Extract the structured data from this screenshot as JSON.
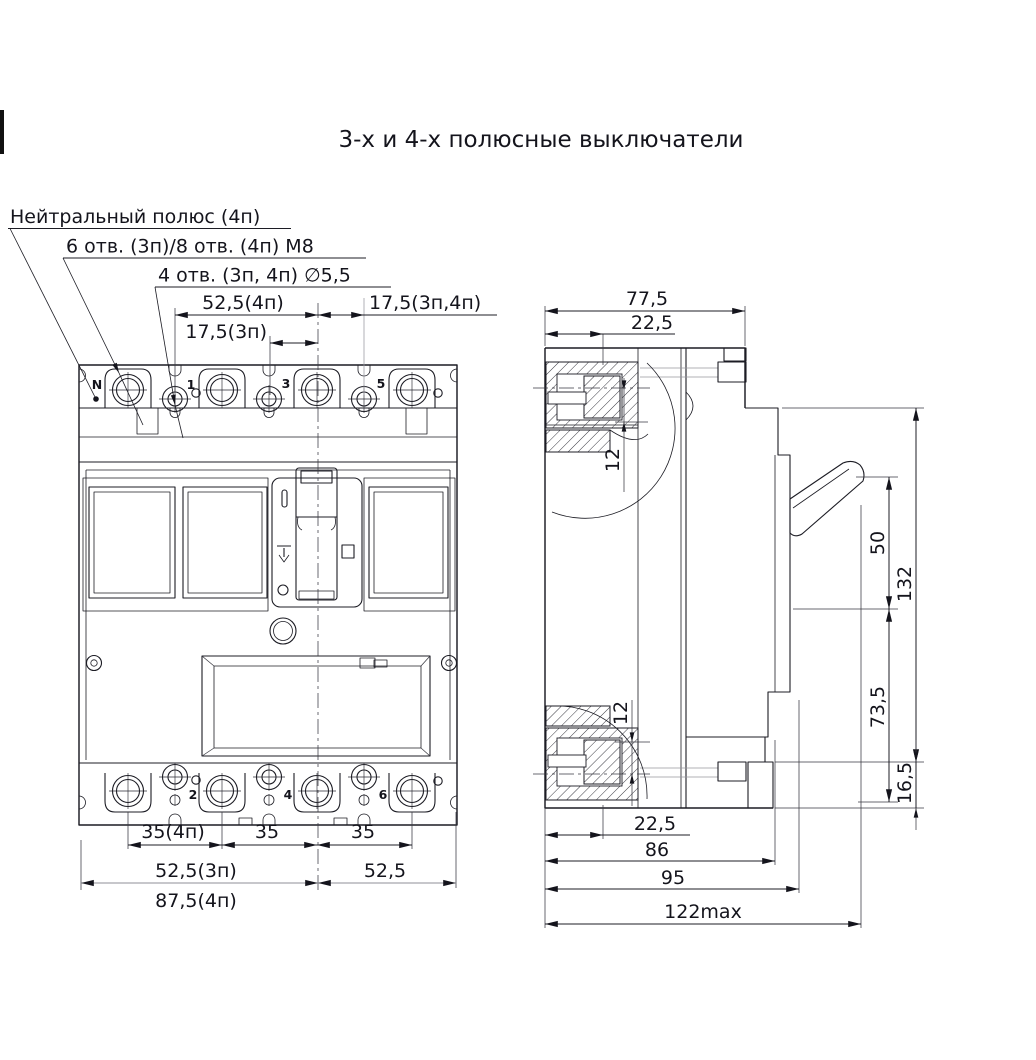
{
  "title": "3-х и 4-х полюсные выключатели",
  "callouts": {
    "neutral_pole": "Нейтральный полюс (4п)",
    "mounting_holes_m8": "6 отв. (3п)/8 отв. (4п) М8",
    "holes_d55": "4 отв. (3п, 4п) ∅5,5"
  },
  "front_view": {
    "terminals_top": [
      "N",
      "1",
      "3",
      "5"
    ],
    "terminals_bottom": [
      "2",
      "4",
      "6"
    ],
    "dims_top": {
      "half_span_4p": "52,5(4п)",
      "offset_3p": "17,5(3п)",
      "offset_right": "17,5(3п,4п)"
    },
    "dims_bottom": {
      "pitch_neutral": "35(4п)",
      "pitch_mid": "35",
      "pitch_right": "35",
      "half_left_3p": "52,5(3п)",
      "half_left_4p": "87,5(4п)",
      "half_right": "52,5"
    }
  },
  "side_view": {
    "dims_top": {
      "depth_total": "77,5",
      "terminal_depth": "22,5",
      "terminal_center_offset": "12"
    },
    "dims_right": {
      "handle_window": "50",
      "height_body": "132",
      "lower_body": "73,5",
      "foot_height": "16,5"
    },
    "dims_bottom": {
      "terminal_center_offset": "12",
      "terminal_depth": "22,5",
      "depth_86": "86",
      "depth_95": "95",
      "depth_max": "122max"
    }
  },
  "colors": {
    "line": "#1c1c24",
    "gray_line": "#97979f",
    "background": "#ffffff"
  }
}
